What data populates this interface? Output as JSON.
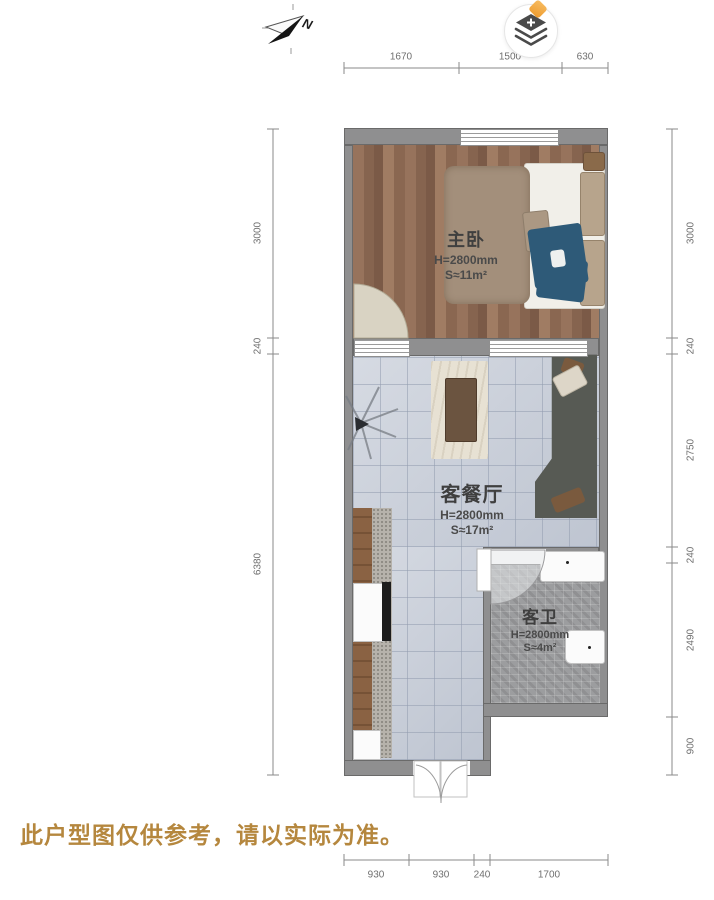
{
  "plan_title": "户型图",
  "compass": {
    "label": "N"
  },
  "toolbar": {
    "layers_button": "图层",
    "badge_color": "#f0a640"
  },
  "rooms": [
    {
      "id": "bedroom",
      "name": "主卧",
      "height": "H=2800mm",
      "area": "S≈11m²",
      "floor": "wood"
    },
    {
      "id": "living",
      "name": "客餐厅",
      "height": "H=2800mm",
      "area": "S≈17m²",
      "floor": "tile"
    },
    {
      "id": "bath",
      "name": "客卫",
      "height": "H=2800mm",
      "area": "S≈4m²",
      "floor": "mosaic"
    }
  ],
  "dimensions": {
    "top": [
      "1670",
      "1500",
      "630"
    ],
    "bottom": [
      "930",
      "930",
      "240",
      "1700"
    ],
    "left": [
      "3000",
      "240",
      "6380"
    ],
    "right": [
      "3000",
      "240",
      "2750",
      "240",
      "2490",
      "900"
    ]
  },
  "disclaimer": "此户型图仅供参考，请以实际为准。",
  "colors": {
    "disclaimer_text": "#b5873e",
    "wall": "#8f8f90",
    "wood_floor": "#8d6b55",
    "tile_floor": "#c8ced9",
    "mosaic_floor": "#9c9d9f",
    "badge": "#f0a640",
    "dimension_text": "#6f6f6f"
  }
}
